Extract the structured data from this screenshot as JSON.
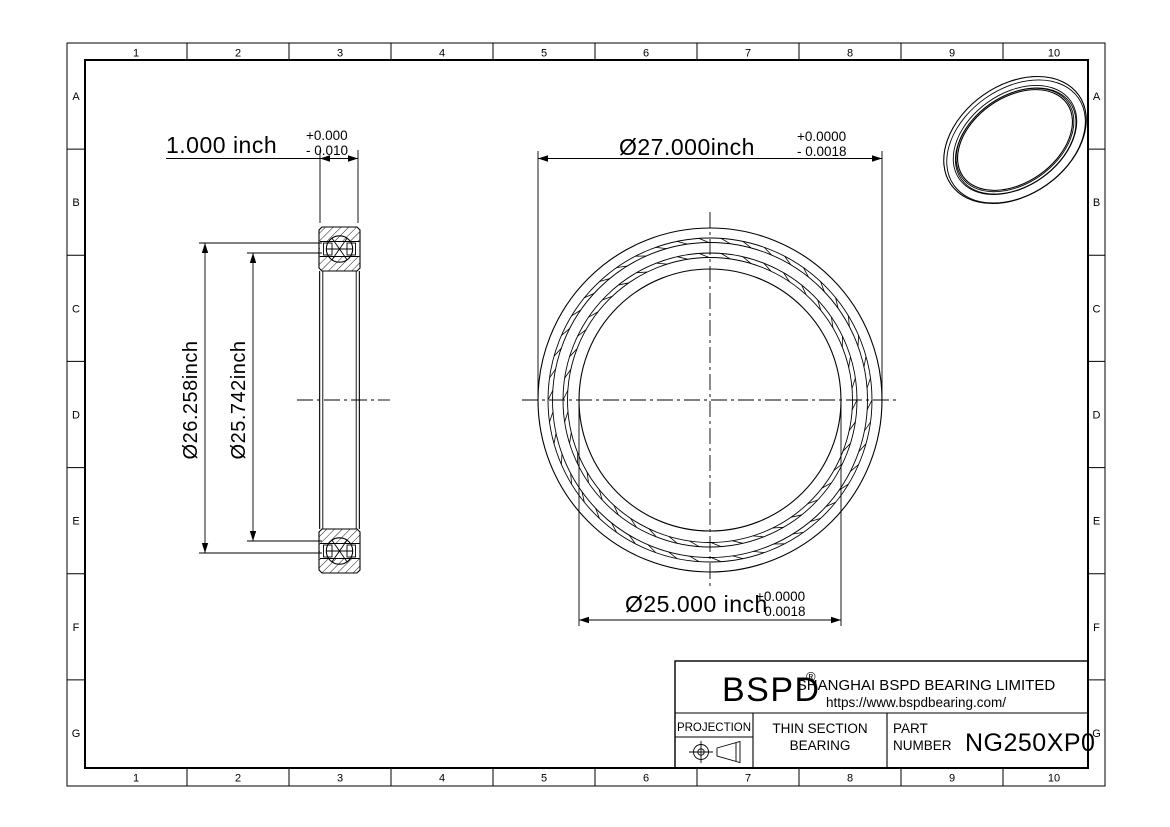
{
  "grid": {
    "columns": [
      "1",
      "2",
      "3",
      "4",
      "5",
      "6",
      "7",
      "8",
      "9",
      "10"
    ],
    "rows": [
      "A",
      "B",
      "C",
      "D",
      "E",
      "F",
      "G"
    ]
  },
  "dimensions": {
    "width": {
      "value": "1.000 inch",
      "tol_plus": "+0.000",
      "tol_minus": "- 0.010"
    },
    "outer_race_diameter": {
      "value": "Ø26.258inch"
    },
    "inner_race_diameter": {
      "value": "Ø25.742inch"
    },
    "outer_diameter": {
      "value": "Ø27.000inch",
      "tol_plus": "+0.0000",
      "tol_minus": "- 0.0018"
    },
    "bore_diameter": {
      "value": "Ø25.000 inch",
      "tol_plus": "+0.0000",
      "tol_minus": "- 0.0018"
    }
  },
  "title_block": {
    "logo": "BSPD",
    "registered_mark": "®",
    "company_name": "SHANGHAI BSPD BEARING LIMITED",
    "website": "https://www.bspdbearing.com/",
    "projection_label": "PROJECTION",
    "product_line1": "THIN SECTION",
    "product_line2": "BEARING",
    "part_label_line1": "PART",
    "part_label_line2": "NUMBER",
    "part_number": "NG250XP0"
  },
  "colors": {
    "line": "#000000",
    "background": "#ffffff"
  }
}
